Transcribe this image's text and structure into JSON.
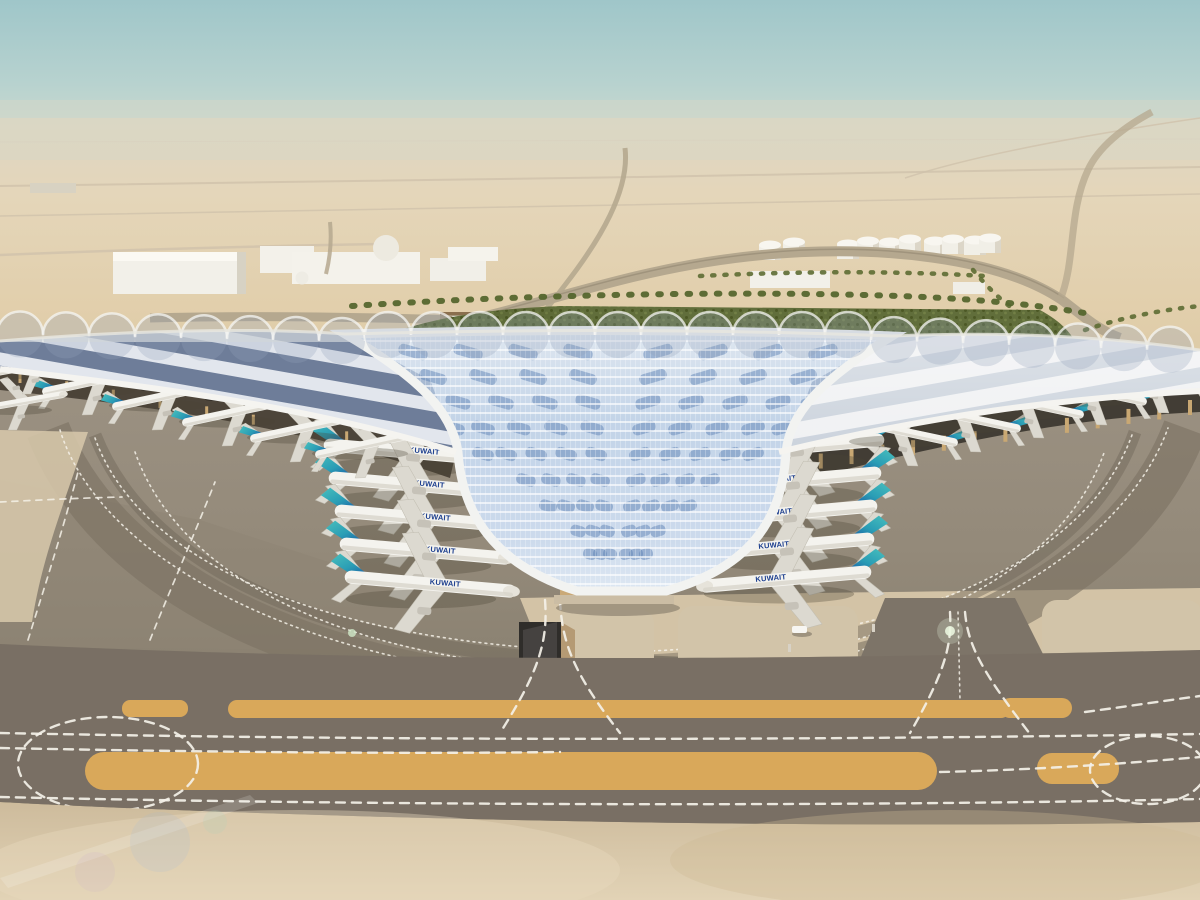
{
  "scene": {
    "aircraft": {
      "title": "KUWAIT",
      "parked_left_stands": 5,
      "parked_right_stands": 5,
      "parked_left_pier": 5,
      "parked_right_pier": 5
    },
    "palette": {
      "sky_top": "#9fc6c9",
      "sky_low": "#ccdcd4",
      "haze": "#e3d9c3",
      "desert": "#e0cda9",
      "sand_foreground": "#d8c6a6",
      "apron": "#958b7b",
      "apron_dark": "#7e756a",
      "taxiway_band": "#7d7468",
      "taxiway_yellow": "#d9a85a",
      "marking_white": "#f4f1e8",
      "roof_white": "#f3f3f0",
      "roof_glass": "#c3d4e8",
      "roof_panel": "#5f84b6",
      "pier_panel": "#5a6d8f",
      "under_shadow": "#3c352b",
      "column_tan": "#c9a873",
      "green_landscape": "#5c6a36",
      "tail_teal": "#49c0bd",
      "tail_blue": "#16417e",
      "fuselage": "#f4f3ee",
      "livery_text": "#1d3f8f"
    }
  }
}
